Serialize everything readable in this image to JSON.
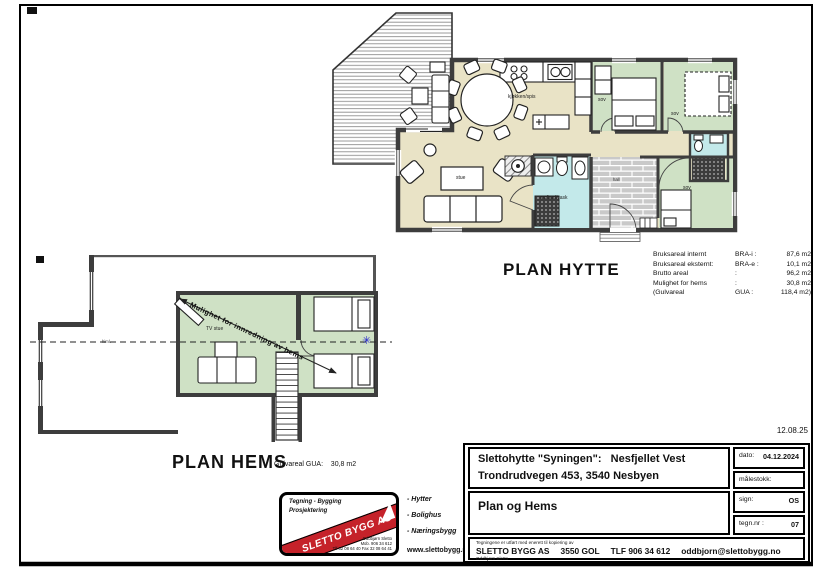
{
  "sheet": {
    "print_date": "12.08.25"
  },
  "plan_hytte": {
    "title": "PLAN HYTTE",
    "labels": {
      "kitchen": "kjøkken/spis",
      "living": "stue",
      "bath": "wc/bad/vask",
      "hall": "hall",
      "bedroom": "sov"
    },
    "area_table": {
      "rows": [
        {
          "label": "Bruksareal internt",
          "code": "BRA-i :",
          "value": "87,6 m2"
        },
        {
          "label": "Bruksareal eksternt:",
          "code": "BRA-e :",
          "value": "10,1 m2"
        },
        {
          "label": "Brutto areal",
          "code": ":",
          "value": "96,2 m2"
        },
        {
          "label": "Mulighet for hems",
          "code": ":",
          "value": "30,8 m2"
        },
        {
          "label": "(Gulvareal",
          "code": "GUA :",
          "value": "118,4 m2)"
        }
      ]
    }
  },
  "plan_hems": {
    "title": "PLAN HEMS",
    "area_note": "Gulvareal GUA:    30,8 m2",
    "labels": {
      "tv_room": "TV stue",
      "ceiling_note": "himl."
    },
    "annotation": "Mulighet for innredning av hems",
    "icons": {
      "marker_star": "✳"
    }
  },
  "logo": {
    "line1": "Tegning - Bygging",
    "line2": "Prosjektering",
    "banner": "SLETTO BYGG AS",
    "contact1": "Oddbjørn Sletto",
    "contact2": "Mob. 906 34 612",
    "contact3": "Tlf 32 08 64 40 Fax 32 08 64 41",
    "services": [
      "- Hytter",
      "- Bolighus",
      "- Næringsbygg"
    ],
    "website": "www.slettobygg.no"
  },
  "titleblock": {
    "project_line1": "Slettohytte \"Syningen\":   Nesfjellet Vest",
    "project_line2": "Trondrudvegen 453, 3540 Nesbyen",
    "drawing_title": "Plan og Hems",
    "dato_label": "dato:",
    "dato_value": "04.12.2024",
    "malestokk_label": "målestokk:",
    "sign_label": "sign:",
    "sign_value": "OS",
    "tegnnr_label": "tegn.nr :",
    "tegnnr_value": "07",
    "copyright_note": "Tegningene er utført med enerett til kopiering av",
    "company_name": "SLETTO BYGG AS",
    "company_city": "3550 GOL",
    "company_phone": "TLF 906 34 612",
    "company_email": "oddbjorn@slettobygg.no",
    "company_person": "Oddbjørn Sletto"
  },
  "colors": {
    "floor": "#e9e3c6",
    "bedroom": "#cfe1c5",
    "bath": "#c3e9ea",
    "brick_base": "#c9c9c9",
    "wall": "#3d3d3d",
    "banner_red": "#c5222a",
    "marker_blue": "#2222cc"
  }
}
